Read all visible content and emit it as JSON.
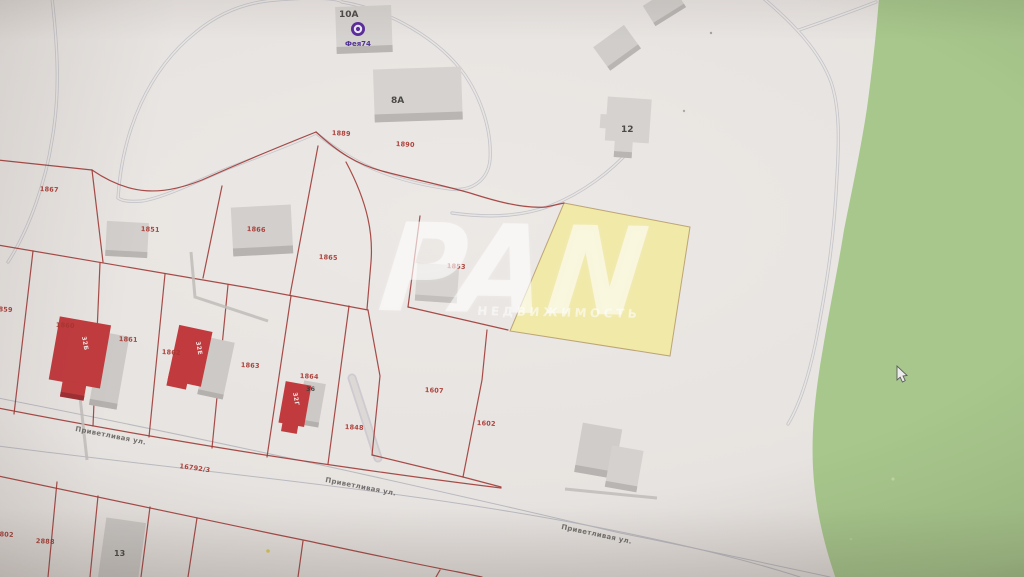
{
  "watermark": {
    "brand": "PAN",
    "subtitle": "НЕДВИЖИМОСТЬ"
  },
  "poi": {
    "name": "Фея74"
  },
  "street": {
    "name": "Приветливая ул.",
    "cadastral_number": "16792/3"
  },
  "colors": {
    "map_background": "#e7e3e0",
    "greenery": "#a7c78c",
    "highlight_parcel": "#f0e996",
    "parcel_line": "#9d3632",
    "building_gray": "#d5d2cf",
    "building_red": "#c13b3e",
    "road_line": "#c4c4ca",
    "poi_purple": "#5b2d9c"
  },
  "labels": {
    "parcels": [
      {
        "text": "1889",
        "x": 332,
        "y": 130,
        "rot": 3
      },
      {
        "text": "1890",
        "x": 396,
        "y": 141,
        "rot": 3
      },
      {
        "text": "1867",
        "x": 40,
        "y": 186,
        "rot": 3
      },
      {
        "text": "1851",
        "x": 141,
        "y": 226,
        "rot": 3
      },
      {
        "text": "1866",
        "x": 247,
        "y": 226,
        "rot": 3
      },
      {
        "text": "1865",
        "x": 319,
        "y": 254,
        "rot": 3
      },
      {
        "text": "1853",
        "x": 447,
        "y": 263,
        "rot": 3
      },
      {
        "text": "1860",
        "x": 56,
        "y": 322,
        "rot": 3
      },
      {
        "text": "1861",
        "x": 119,
        "y": 336,
        "rot": 3
      },
      {
        "text": "1862",
        "x": 162,
        "y": 349,
        "rot": 3
      },
      {
        "text": "1863",
        "x": 241,
        "y": 362,
        "rot": 3
      },
      {
        "text": "1864",
        "x": 300,
        "y": 373,
        "rot": 3
      },
      {
        "text": "1848",
        "x": 345,
        "y": 424,
        "rot": 3
      },
      {
        "text": "1607",
        "x": 425,
        "y": 387,
        "rot": 3
      },
      {
        "text": "1602",
        "x": 477,
        "y": 420,
        "rot": 3
      },
      {
        "text": "16792/3",
        "x": 180,
        "y": 463,
        "rot": 8
      },
      {
        "text": "1859",
        "x": -6,
        "y": 306,
        "rot": 3
      },
      {
        "text": "1802",
        "x": -5,
        "y": 531,
        "rot": 3
      },
      {
        "text": "2888",
        "x": 36,
        "y": 538,
        "rot": 3
      }
    ],
    "buildings": [
      {
        "text": "10А",
        "x": 339,
        "y": 11,
        "size": 9
      },
      {
        "text": "8А",
        "x": 391,
        "y": 97,
        "size": 9
      },
      {
        "text": "12",
        "x": 621,
        "y": 126,
        "size": 9
      },
      {
        "text": "13",
        "x": 114,
        "y": 550,
        "size": 8
      },
      {
        "text": "36",
        "x": 306,
        "y": 386,
        "size": 6.5
      }
    ],
    "streets": [
      {
        "text": "Приветливая ул.",
        "x": 76,
        "y": 426,
        "rot": 11
      },
      {
        "text": "Приветливая ул.",
        "x": 326,
        "y": 477,
        "rot": 11
      },
      {
        "text": "Приветливая ул.",
        "x": 562,
        "y": 524,
        "rot": 12
      }
    ],
    "house_marks": [
      {
        "text": "32Б",
        "x": 86,
        "y": 336,
        "rot": 80
      },
      {
        "text": "32Е",
        "x": 200,
        "y": 341,
        "rot": 80
      },
      {
        "text": "32Г",
        "x": 297,
        "y": 392,
        "rot": 80
      }
    ]
  }
}
